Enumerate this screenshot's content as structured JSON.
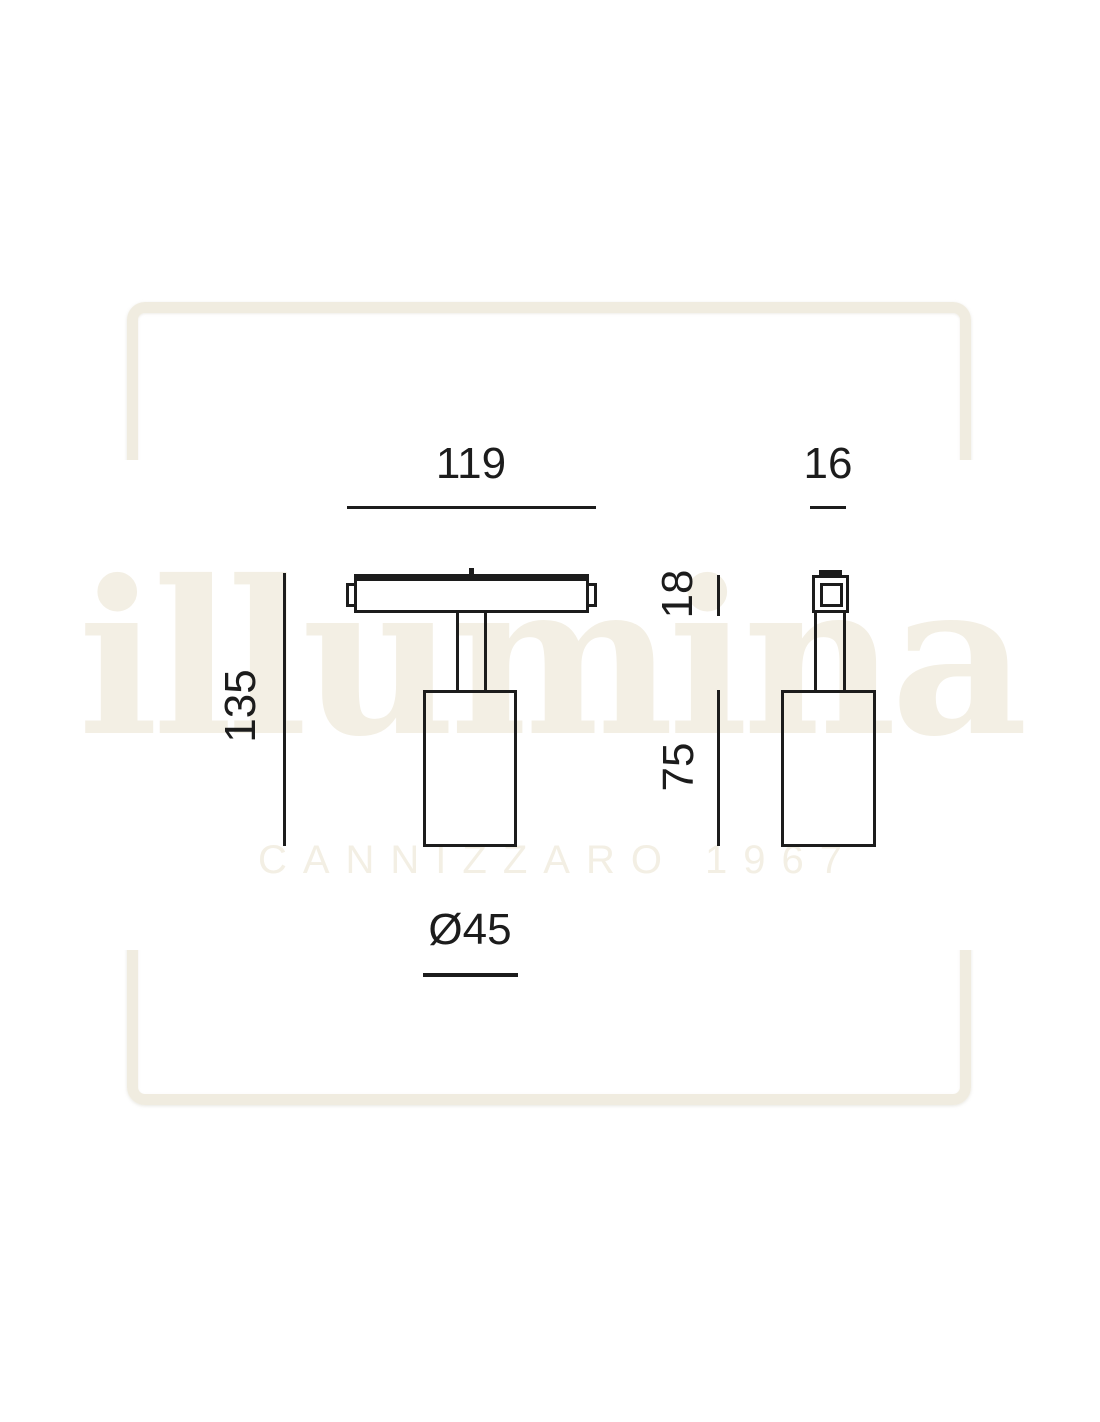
{
  "watermark": {
    "brand": "illumina",
    "subtitle": "CANNIZZARO 1967"
  },
  "drawing": {
    "type": "technical-dimension-drawing",
    "subject": "magnetic track spotlight, front and side views",
    "dimensions": {
      "track_adapter_width": "119",
      "side_depth": "16",
      "overall_height": "135",
      "track_adapter_height": "18",
      "body_height": "75",
      "body_diameter": "Ø45"
    }
  },
  "colors": {
    "background": "#ffffff",
    "line": "#1c1c1c",
    "watermark": "#f3efe4",
    "frame": "#f0ece0"
  }
}
